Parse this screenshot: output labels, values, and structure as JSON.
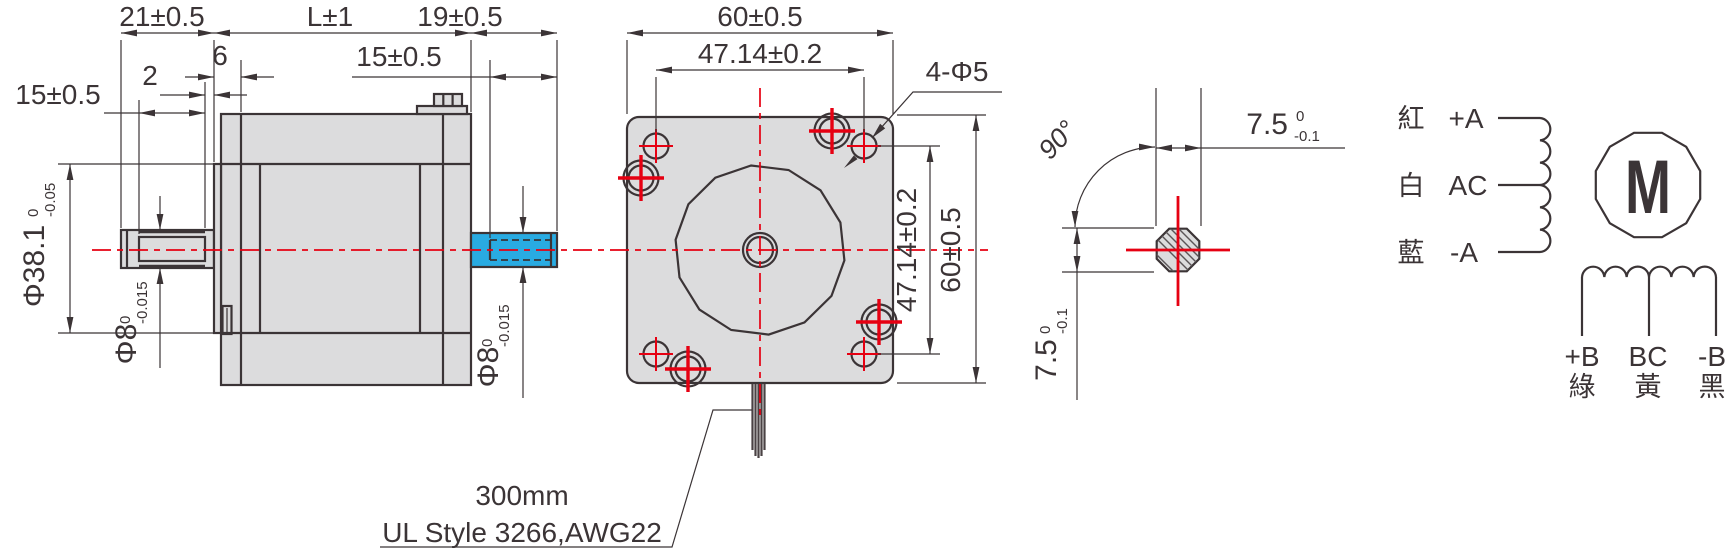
{
  "drawing_type": "stepper-motor-outline-drawing",
  "side_view": {
    "shaft_front_length": "21±0.5",
    "body_length": "L±1",
    "shaft_rear_length": "19±0.5",
    "front_boss_depth": "6",
    "flat_to_face_gap": "2",
    "front_shaft_flat_length": "15±0.5",
    "rear_shaft_flat_length": "15±0.5",
    "pilot_diameter": {
      "value": "Φ38.1",
      "tol_upper": "0",
      "tol_lower": "-0.05"
    },
    "front_shaft_diameter": {
      "value": "Φ8",
      "tol_upper": "0",
      "tol_lower": "-0.015"
    },
    "rear_shaft_diameter": {
      "value": "Φ8",
      "tol_upper": "0",
      "tol_lower": "-0.015"
    }
  },
  "front_view": {
    "width": "60±0.5",
    "hole_spacing_horizontal": "47.14±0.2",
    "mounting_holes": "4-Φ5",
    "hole_spacing_vertical": "47.14±0.2",
    "height": "60±0.5",
    "cable_length_note": "300mm",
    "cable_spec_note": "UL Style 3266,AWG22"
  },
  "shaft_section": {
    "flat_angle": "90°",
    "flat_width_horizontal": {
      "value": "7.5",
      "tol_upper": "0",
      "tol_lower": "-0.1"
    },
    "flat_width_vertical": {
      "value": "7.5",
      "tol_upper": "0",
      "tol_lower": "-0.1"
    }
  },
  "wiring_diagram": {
    "motor_symbol": "M",
    "phase_a_leads": [
      {
        "wire_color": "紅",
        "terminal": "+A"
      },
      {
        "wire_color": "白",
        "terminal": "AC"
      },
      {
        "wire_color": "藍",
        "terminal": "-A"
      }
    ],
    "phase_b_leads": [
      {
        "terminal": "+B",
        "wire_color": "綠"
      },
      {
        "terminal": "BC",
        "wire_color": "黃"
      },
      {
        "terminal": "-B",
        "wire_color": "黑"
      }
    ]
  },
  "colors": {
    "line": "#3b3436",
    "red": "#e60012",
    "fill": "#dcdcdd",
    "blue": "#29abe2",
    "cable": "#4a4244",
    "hatch": "#5a5557"
  }
}
